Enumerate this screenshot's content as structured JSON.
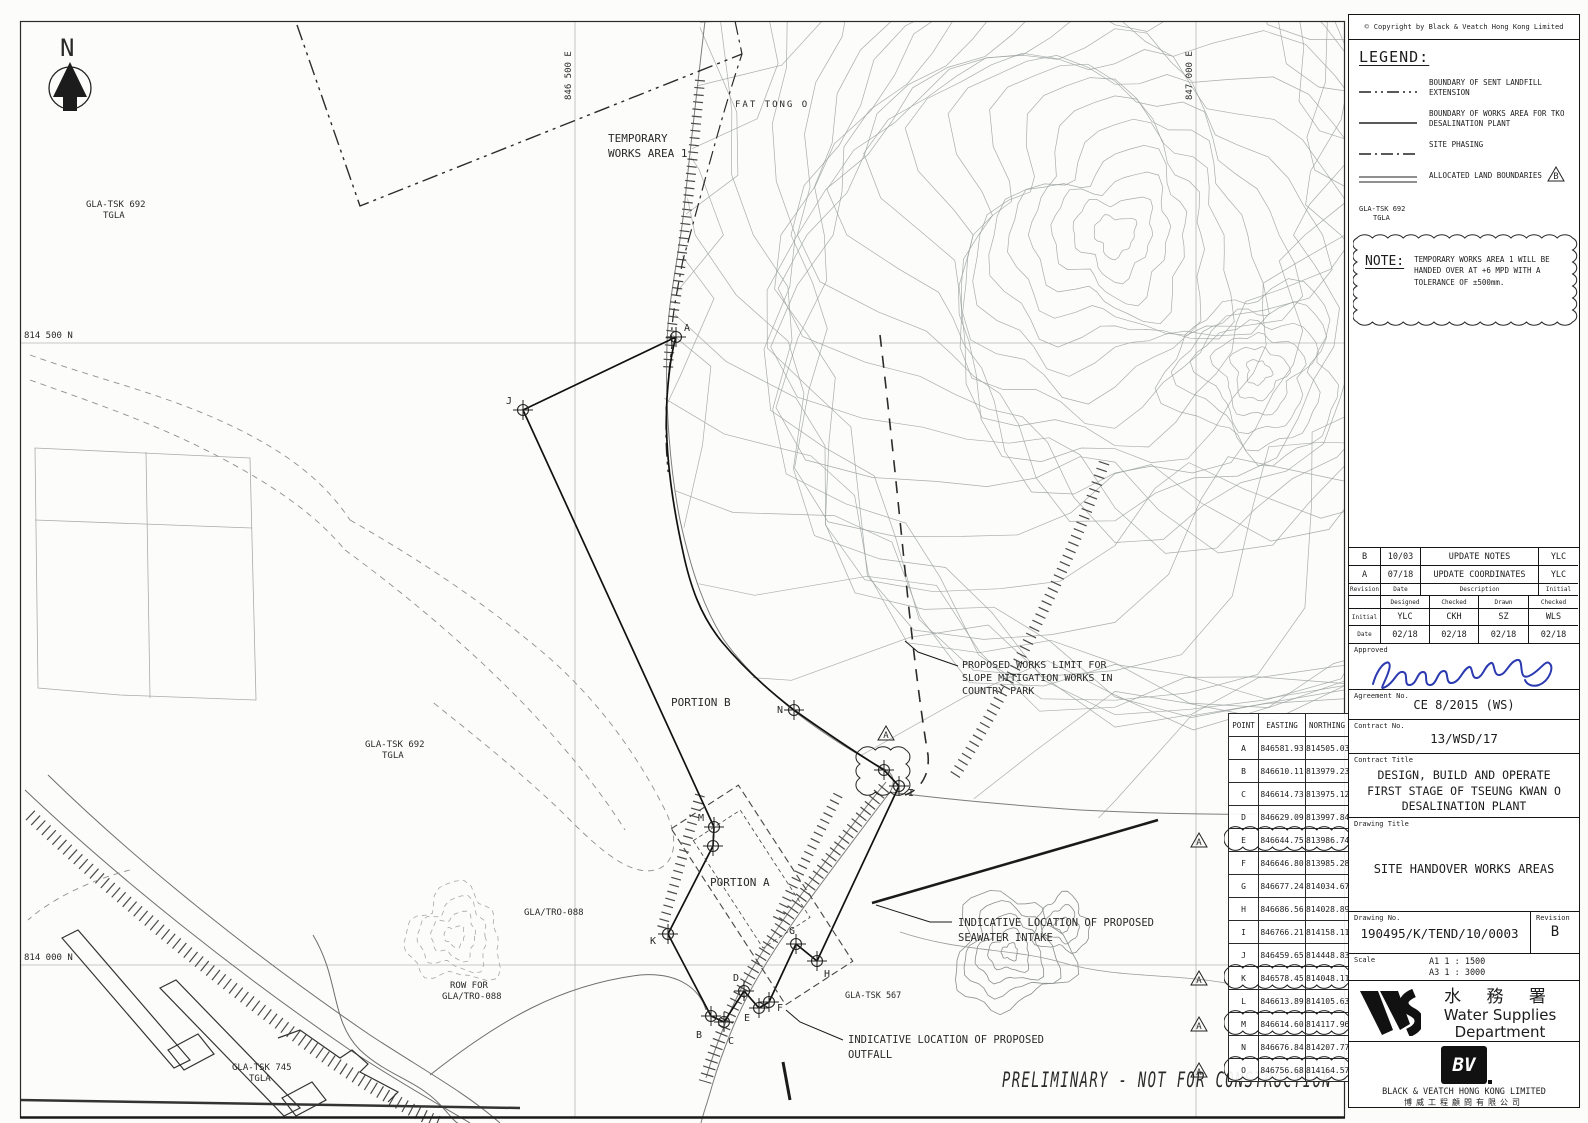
{
  "map": {
    "north_label": "N",
    "grid": {
      "n_top": "814 500 N",
      "n_bottom": "814 000 N",
      "e_left": "846 500 E",
      "e_right": "847 000 E"
    },
    "labels": {
      "temporary_works_1": "TEMPORARY",
      "temporary_works_2": "WORKS AREA 1",
      "gla_692_a1": "GLA-TSK 692",
      "gla_692_a2": "TGLA",
      "gla_692_b1": "GLA-TSK 692",
      "gla_692_b2": "TGLA",
      "fat_tong_o": "FAT TONG O",
      "portion_b": "PORTION B",
      "portion_a": "PORTION A",
      "gla_tro": "GLA/TRO-088",
      "row_for_1": "ROW FOR",
      "row_for_2": "GLA/TRO-088",
      "gla_745_1": "GLA-TSK 745",
      "gla_745_2": "TGLA",
      "gla_567": "GLA-TSK 567",
      "slope_1": "PROPOSED WORKS LIMIT FOR",
      "slope_2": "SLOPE MITIGATION WORKS IN",
      "slope_3": "COUNTRY PARK",
      "intake_1": "INDICATIVE LOCATION OF PROPOSED",
      "intake_2": "SEAWATER INTAKE",
      "outfall_1": "INDICATIVE LOCATION OF PROPOSED",
      "outfall_2": "OUTFALL",
      "preliminary": "PRELIMINARY  -  NOT FOR CONSTRUCTION"
    }
  },
  "coords_table": {
    "headers": [
      "POINT",
      "EASTING",
      "NORTHING"
    ],
    "triangle": "A",
    "rows": [
      {
        "point": "A",
        "easting": "846581.93",
        "northing": "814505.03",
        "revised": false
      },
      {
        "point": "B",
        "easting": "846610.11",
        "northing": "813979.23",
        "revised": false
      },
      {
        "point": "C",
        "easting": "846614.73",
        "northing": "813975.12",
        "revised": false
      },
      {
        "point": "D",
        "easting": "846629.09",
        "northing": "813997.84",
        "revised": false
      },
      {
        "point": "E",
        "easting": "846644.75",
        "northing": "813986.74",
        "revised": true
      },
      {
        "point": "F",
        "easting": "846646.80",
        "northing": "813985.28",
        "revised": false
      },
      {
        "point": "G",
        "easting": "846677.24",
        "northing": "814034.67",
        "revised": false
      },
      {
        "point": "H",
        "easting": "846686.56",
        "northing": "814028.89",
        "revised": false
      },
      {
        "point": "I",
        "easting": "846766.21",
        "northing": "814158.11",
        "revised": false
      },
      {
        "point": "J",
        "easting": "846459.65",
        "northing": "814448.83",
        "revised": false
      },
      {
        "point": "K",
        "easting": "846578.45",
        "northing": "814048.11",
        "revised": true
      },
      {
        "point": "L",
        "easting": "846613.89",
        "northing": "814105.63",
        "revised": false
      },
      {
        "point": "M",
        "easting": "846614.60",
        "northing": "814117.96",
        "revised": true
      },
      {
        "point": "N",
        "easting": "846676.84",
        "northing": "814207.77",
        "revised": false
      },
      {
        "point": "O",
        "easting": "846756.68",
        "northing": "814164.57",
        "revised": true
      }
    ]
  },
  "titleblock": {
    "copyright_symbol": "©",
    "copyright": "Copyright by Black & Veatch Hong Kong Limited",
    "legend": {
      "heading": "LEGEND:",
      "item1": "BOUNDARY OF SENT LANDFILL EXTENSION",
      "item2": "BOUNDARY OF WORKS AREA FOR TKO DESALINATION PLANT",
      "item3": "SITE PHASING",
      "item4": "ALLOCATED LAND BOUNDARIES",
      "allocated_tag1": "GLA-TSK 692",
      "allocated_tag2": "TGLA",
      "rev_triangle": "B"
    },
    "note": {
      "heading": "NOTE:",
      "text": "TEMPORARY WORKS AREA 1 WILL BE HANDED OVER AT +6 MPD WITH A TOLERANCE OF ±500mm."
    },
    "revisions": {
      "rows": [
        [
          "B",
          "10/03",
          "UPDATE NOTES",
          "YLC"
        ],
        [
          "A",
          "07/18",
          "UPDATE COORDINATES",
          "YLC"
        ]
      ],
      "header": [
        "Revision",
        "Date",
        "Description",
        "Initial"
      ]
    },
    "signoff": {
      "cols": [
        "Designed",
        "Checked",
        "Drawn",
        "Checked"
      ],
      "initial_label": "Initial",
      "initials": [
        "YLC",
        "CKH",
        "SZ",
        "WLS"
      ],
      "date_label": "Date",
      "dates": [
        "02/18",
        "02/18",
        "02/18",
        "02/18"
      ]
    },
    "approved_label": "Approved",
    "agreement": {
      "label": "Agreement No.",
      "value": "CE 8/2015 (WS)"
    },
    "contract_no": {
      "label": "Contract No.",
      "value": "13/WSD/17"
    },
    "contract_title": {
      "label": "Contract Title",
      "line1": "DESIGN, BUILD AND OPERATE",
      "line2": "FIRST STAGE OF TSEUNG KWAN O",
      "line3": "DESALINATION PLANT"
    },
    "drawing_title": {
      "label": "Drawing Title",
      "value": "SITE HANDOVER WORKS AREAS"
    },
    "drawing_no": {
      "label": "Drawing No.",
      "value": "190495/K/TEND/10/0003",
      "rev_label": "Revision",
      "rev": "B"
    },
    "scale": {
      "label": "Scale",
      "line1": "A1 1 : 1500",
      "line2": "A3 1 : 3000"
    },
    "wsd": {
      "cn": "水 務 署",
      "en1": "Water Supplies",
      "en2": "Department"
    },
    "bv": {
      "logo": "BV",
      "en": "BLACK & VEATCH HONG KONG LIMITED",
      "cn": "博威工程顧問有限公司"
    }
  }
}
